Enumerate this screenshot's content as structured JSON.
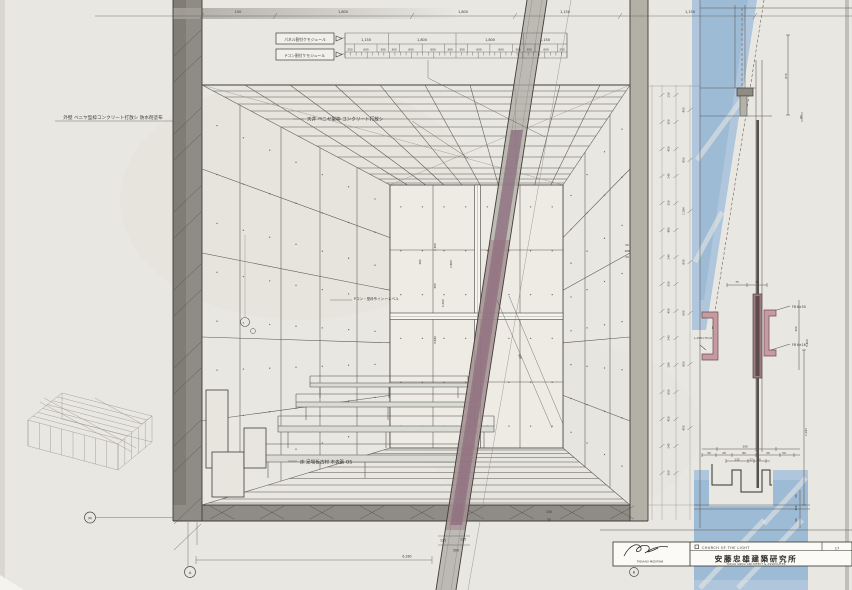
{
  "sheet": {
    "project": "CHURCH OF THE LIGHT",
    "firm_jp": "安藤忠雄建築研究所",
    "firm_en": "TADAO ANDO ARCHITECT & ASSOCIATES",
    "sheet_no": "17",
    "signature": "TADAAKI MIZUTANI"
  },
  "markers": {
    "left": "M",
    "bottom": "A",
    "right": "B"
  },
  "annotations": {
    "exterior_wall": "外壁 ベニヤ型枠コンクリート打放シ 防水剤塗布",
    "ceiling": "天井 ベニヤ型枠 コンクリート打放シ",
    "wall_joint": "Pコン・型枠ライン ←レベル",
    "floor": "床 足場板古材 木表張 OS",
    "panel_module": "パネル割付ケモジュール",
    "pcon_module": "Pコン割付ケモジュール"
  },
  "detail_labels": {
    "fb_top": "FB 6×50",
    "fb_bottom": "FB 6×16",
    "angle": "L-150×75×9"
  },
  "colors": {
    "paper": "#e9e7e1",
    "graphite": "#8f8c85",
    "blue_pencil": "#a5c0da",
    "purple_band": "#8d6b80",
    "steel_pink": "#c59aa0"
  },
  "dims": {
    "top_overall": [
      "150",
      "1,800",
      "1,800",
      "1,150",
      "1,150"
    ],
    "module_row": [
      "1,150",
      "1,800",
      "1,800",
      "1,150"
    ],
    "pcon_row": [
      "250",
      "600",
      "300",
      "300",
      "600",
      "600",
      "300",
      "300",
      "600",
      "600",
      "300",
      "300",
      "600",
      "250"
    ],
    "chain_inner": [
      "210",
      "150",
      "450",
      "245",
      "310",
      "480",
      "240",
      "310",
      "450",
      "243",
      "280",
      "810",
      "450",
      "245",
      "150"
    ],
    "chain_outer": [
      "455",
      "855",
      "2,280",
      "856",
      "600",
      "855",
      "455"
    ],
    "chain_small": [
      "50",
      "180",
      "20"
    ],
    "back_wall": [
      "2,160",
      "380",
      "305",
      "1,000",
      "3,840",
      "2,860"
    ],
    "diag": [
      "500"
    ],
    "floor_front": [
      "125",
      "125",
      "500",
      "6,280",
      "150",
      "50"
    ],
    "head": [
      "870",
      "80"
    ],
    "mid_horiz": [
      "75",
      "75"
    ],
    "mid_rot": [
      "150",
      "5,400"
    ],
    "sill_top": [
      "390",
      "50",
      "20",
      "80",
      "20",
      "50",
      "135",
      "17",
      "50"
    ],
    "sill_right": [
      "2,292",
      "50",
      "150",
      "50"
    ]
  }
}
